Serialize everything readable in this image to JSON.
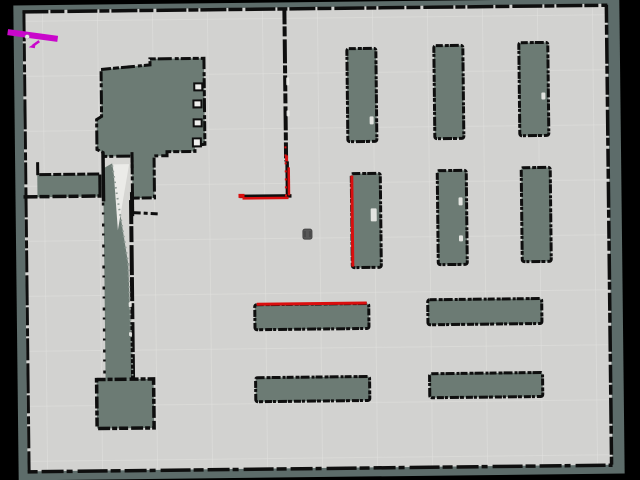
{
  "scene": {
    "kind": "occupancy-grid-map-view",
    "rotation_deg": -0.65,
    "pivot": [
      320,
      240
    ]
  },
  "colors": {
    "background": "#000000",
    "unknown_exterior": "#5d6c6a",
    "unknown_interior": "#6c7b74",
    "free_space": "#d2d2d0",
    "free_space_light": "#d6d6d3",
    "white_patch": "#ebebe8",
    "wall": "#0e0e0e",
    "laser": "#da0e0e",
    "path": "#c907cb",
    "robot_fill": "#585858",
    "robot_stroke": "#454545",
    "grid": "#e2e2df",
    "dither": "#8f9a94",
    "speck": "#efefec",
    "notch_fill": "#eeeeec"
  },
  "map": {
    "exterior": {
      "x": 16,
      "y": 2,
      "w": 606,
      "h": 475
    },
    "free": {
      "x": 25,
      "y": 7,
      "w": 585,
      "h": 461
    }
  },
  "grid": {
    "spacing": 55,
    "x0": 45,
    "y0": 18,
    "opacity": 0.5
  },
  "regions": [
    {
      "name": "corridor-free-gap",
      "type": "rect",
      "x": 104,
      "y": 155,
      "w": 29,
      "h": 222,
      "fill": "free_space_light"
    },
    {
      "name": "corridor-unknown-band",
      "type": "poly",
      "points": "104,166 113,161 128,262 131,377 104,377",
      "fill": "unknown_interior"
    },
    {
      "name": "corridor-white-wedge",
      "type": "poly",
      "points": "114,162 130,162 118,228",
      "fill": "white_patch"
    },
    {
      "name": "left-room",
      "type": "poly",
      "points": "103,67 152,63 152,57 206,57 206,143 196,144 196,150 168,150 168,154 155,154 155,196 133,196 133,154 104,154 104,150 98,147 98,117 103,114",
      "fill": "unknown_interior",
      "stroke": "wall",
      "sw": 3,
      "dash": "10 2 6 2 14 3 4 2"
    },
    {
      "name": "left-strip",
      "type": "rect",
      "x": 38,
      "y": 172,
      "w": 64,
      "h": 22,
      "fill": "unknown_interior"
    },
    {
      "name": "bottom-left-block",
      "type": "rect",
      "x": 95,
      "y": 377,
      "w": 57,
      "h": 49,
      "fill": "unknown_interior",
      "stroke": "wall",
      "sw": 3.5,
      "dash": "9 2 5 2 12 3"
    }
  ],
  "shelves": [
    {
      "name": "shelf-top-1",
      "x": 349,
      "y": 49,
      "w": 29,
      "h": 93
    },
    {
      "name": "shelf-top-2",
      "x": 436,
      "y": 47,
      "w": 29,
      "h": 93
    },
    {
      "name": "shelf-top-3",
      "x": 521,
      "y": 45,
      "w": 29,
      "h": 93
    },
    {
      "name": "shelf-mid-1",
      "x": 352,
      "y": 174,
      "w": 29,
      "h": 94
    },
    {
      "name": "shelf-mid-2",
      "x": 438,
      "y": 172,
      "w": 29,
      "h": 94
    },
    {
      "name": "shelf-mid-3",
      "x": 522,
      "y": 170,
      "w": 29,
      "h": 94
    },
    {
      "name": "shelf-row1-left",
      "x": 254,
      "y": 304,
      "w": 114,
      "h": 25
    },
    {
      "name": "shelf-row1-right",
      "x": 427,
      "y": 301,
      "w": 114,
      "h": 25
    },
    {
      "name": "shelf-row2-left",
      "x": 254,
      "y": 377,
      "w": 114,
      "h": 24
    },
    {
      "name": "shelf-row2-right",
      "x": 428,
      "y": 375,
      "w": 113,
      "h": 24
    }
  ],
  "walls": [
    {
      "name": "outer-top",
      "x1": 25,
      "y1": 8.5,
      "x2": 610,
      "y2": 8.5,
      "w": 3.5,
      "dash": "26 2 14 3 30 2 10 2"
    },
    {
      "name": "outer-left",
      "x1": 26.5,
      "y1": 8,
      "x2": 26.5,
      "y2": 468,
      "w": 3,
      "dash": "30 2 18 3 8 2 22 3"
    },
    {
      "name": "outer-right",
      "x1": 609,
      "y1": 8,
      "x2": 609,
      "y2": 468,
      "w": 3.5,
      "dash": "18 2 10 3 26 2 8 3"
    },
    {
      "name": "outer-bottom",
      "x1": 25,
      "y1": 468.5,
      "x2": 610,
      "y2": 468.5,
      "w": 3.5,
      "dash": "10 4 22 3 6 5 30 3"
    },
    {
      "name": "center-vertical-wall",
      "x1": 287,
      "y1": 8,
      "x2": 287,
      "y2": 161,
      "w": 4,
      "dash": "16 2 10 3 24 2 8 2"
    },
    {
      "name": "l-wall-vertical",
      "x1": 288,
      "y1": 161,
      "x2": 288,
      "y2": 196,
      "w": 3.5
    },
    {
      "name": "l-wall-horizontal",
      "x1": 240,
      "y1": 195.5,
      "x2": 292,
      "y2": 195.5,
      "w": 3.5
    },
    {
      "name": "strip-top",
      "x1": 40,
      "y1": 171.5,
      "x2": 102,
      "y2": 171.5,
      "w": 3,
      "dash": "12 2 8 2"
    },
    {
      "name": "strip-bottom",
      "x1": 24,
      "y1": 193.5,
      "x2": 102,
      "y2": 193.5,
      "w": 3.5,
      "dash": "14 2 10 3"
    },
    {
      "name": "strip-left-stub",
      "x1": 38.5,
      "y1": 159,
      "x2": 38.5,
      "y2": 172,
      "w": 3
    },
    {
      "name": "strip-right-edge",
      "x1": 100.5,
      "y1": 172,
      "x2": 100.5,
      "y2": 193,
      "w": 3
    },
    {
      "name": "corridor-left-wall",
      "x1": 104,
      "y1": 150,
      "x2": 104,
      "y2": 199,
      "w": 3.5
    },
    {
      "name": "corridor-left-dotted",
      "x1": 103.5,
      "y1": 200,
      "x2": 103,
      "y2": 377,
      "w": 2.5,
      "dash": "3 7 2 9"
    },
    {
      "name": "corridor-right-wall",
      "x1": 131.5,
      "y1": 198,
      "x2": 131.5,
      "y2": 377,
      "w": 4,
      "dash": "24 2 16 3 30 2"
    },
    {
      "name": "corridor-right-upper",
      "x1": 133,
      "y1": 150,
      "x2": 133,
      "y2": 166,
      "w": 3
    },
    {
      "name": "corridor-right-stub",
      "x1": 132.5,
      "y1": 190,
      "x2": 132.5,
      "y2": 214,
      "w": 4
    },
    {
      "name": "extension-bottom-stub",
      "x1": 133,
      "y1": 210.5,
      "x2": 158,
      "y2": 212,
      "w": 3,
      "dash": "8 3 4 3"
    },
    {
      "name": "dither-diagonal-upper",
      "x1": 113,
      "y1": 163,
      "x2": 128,
      "y2": 262,
      "w": 2,
      "dash": "1.5 4",
      "color": "dither"
    },
    {
      "name": "dither-diagonal-lower",
      "x1": 128,
      "y1": 262,
      "x2": 131,
      "y2": 374,
      "w": 2,
      "dash": "1.5 4",
      "color": "dither"
    }
  ],
  "lasers": [
    {
      "name": "scan-shelf-mid-1-left",
      "x1": 352.5,
      "y1": 176,
      "x2": 352.5,
      "y2": 267,
      "w": 3
    },
    {
      "name": "scan-shelf-row1-top",
      "x1": 256,
      "y1": 303.5,
      "x2": 366,
      "y2": 303.5,
      "w": 3
    },
    {
      "name": "scan-l-wall-vertical",
      "x1": 289.5,
      "y1": 167,
      "x2": 289.5,
      "y2": 195,
      "w": 2.5
    },
    {
      "name": "scan-l-wall-horizontal",
      "x1": 243,
      "y1": 197.5,
      "x2": 289,
      "y2": 197.5,
      "w": 2.5
    },
    {
      "name": "scan-l-wall-tip",
      "x1": 239,
      "y1": 195,
      "x2": 245,
      "y2": 195,
      "w": 4
    },
    {
      "name": "scan-wall-speck",
      "x1": 287.5,
      "y1": 155,
      "x2": 287.5,
      "y2": 161,
      "w": 3
    },
    {
      "name": "scan-l-wall-sparse",
      "x1": 286.5,
      "y1": 146,
      "x2": 286.5,
      "y2": 196,
      "w": 2,
      "dash": "2 6"
    }
  ],
  "path_marker": {
    "main": {
      "x1": 13,
      "y1": 29,
      "x2": 57,
      "y2": 35.5,
      "w": 6
    },
    "arrow_line": {
      "x1": 41.5,
      "y1": 38,
      "x2": 35,
      "y2": 42.5,
      "w": 2.5
    },
    "arrow_head": "31,44 38,39.5 37,45",
    "dot": {
      "cx": 29.5,
      "cy": 33.5,
      "r": 2.2
    }
  },
  "robot": {
    "x": 303,
    "y": 229,
    "w": 9,
    "h": 10
  },
  "notches": [
    {
      "x": 196,
      "y": 82,
      "w": 8,
      "h": 7
    },
    {
      "x": 195,
      "y": 99,
      "w": 8,
      "h": 7
    },
    {
      "x": 195,
      "y": 118,
      "w": 8,
      "h": 7
    },
    {
      "x": 194,
      "y": 137,
      "w": 8,
      "h": 8
    }
  ],
  "specks": [
    {
      "x": 371,
      "y": 209,
      "w": 6,
      "h": 13
    },
    {
      "x": 459,
      "y": 199,
      "w": 4,
      "h": 8
    },
    {
      "x": 459,
      "y": 237,
      "w": 4,
      "h": 6
    },
    {
      "x": 543,
      "y": 95,
      "w": 4,
      "h": 7
    },
    {
      "x": 371,
      "y": 117,
      "w": 4,
      "h": 8
    },
    {
      "x": 288,
      "y": 77,
      "w": 3,
      "h": 8
    },
    {
      "x": 288,
      "y": 110,
      "w": 3,
      "h": 6
    },
    {
      "x": 128,
      "y": 300,
      "w": 3,
      "h": 5
    },
    {
      "x": 128,
      "y": 330,
      "w": 3,
      "h": 4
    }
  ]
}
